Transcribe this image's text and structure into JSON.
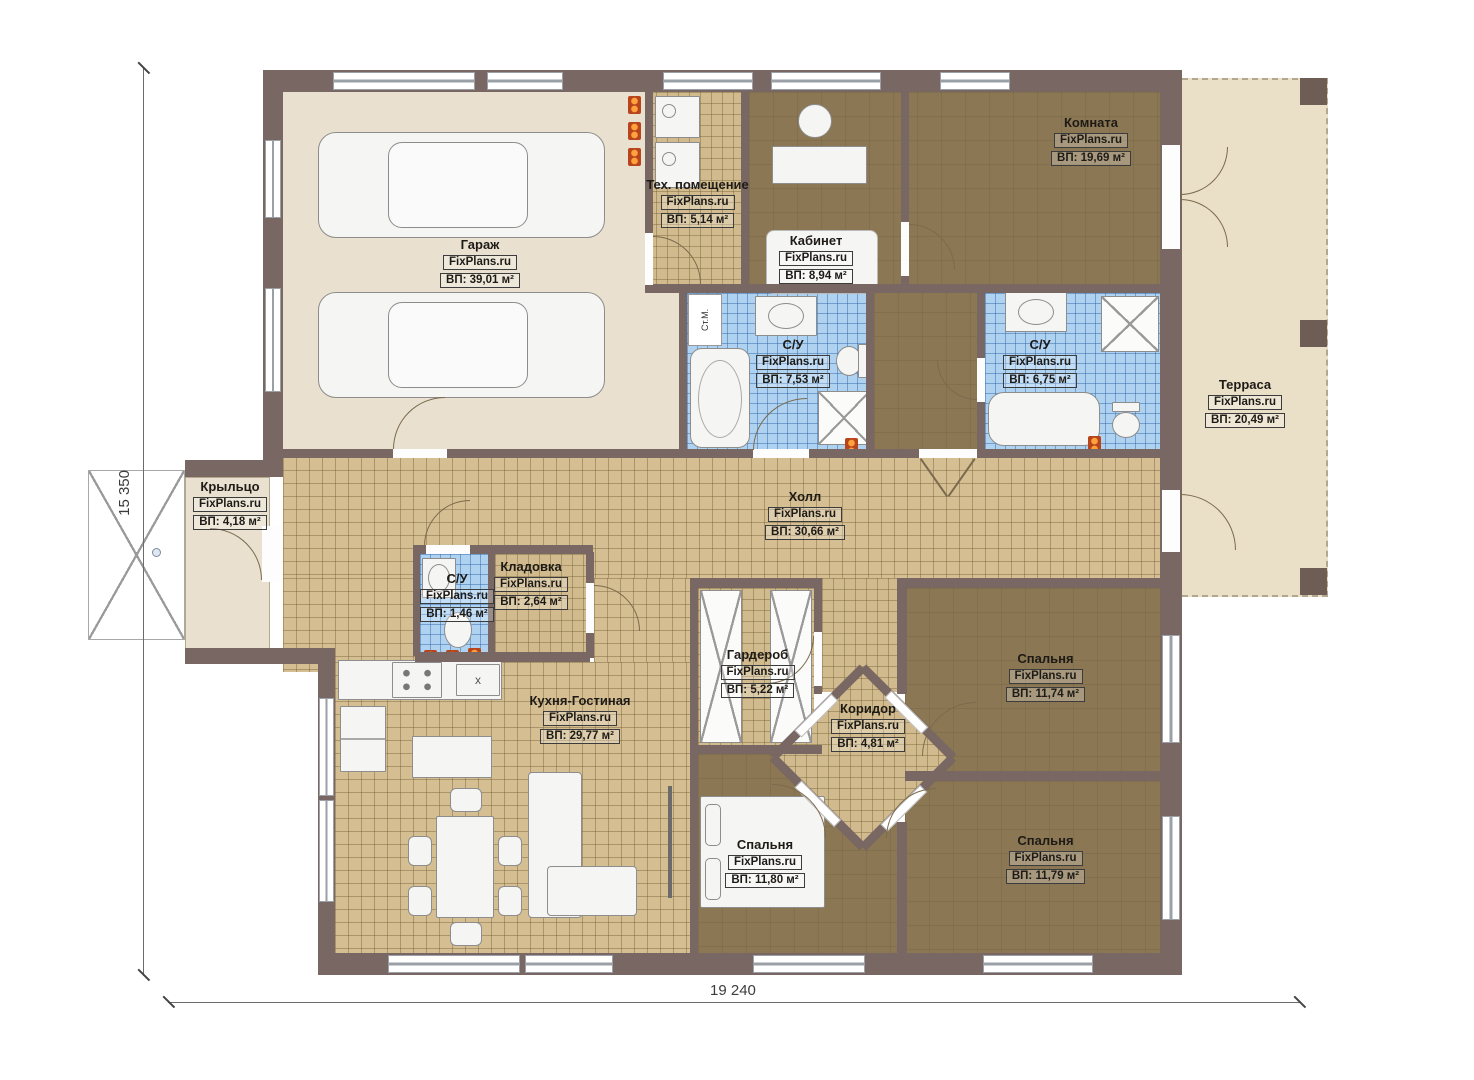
{
  "watermark": "FixPlans.ru",
  "dimensions": {
    "width_label": "19 240",
    "height_label": "15 350"
  },
  "annotations": {
    "washing_machine": "Ст.М.",
    "sink_mark": "x"
  },
  "colors": {
    "wall": "#786762",
    "floor_tile_tan": "#d4be92",
    "floor_tile_blue": "#aed2f0",
    "floor_brown": "#8b7753",
    "floor_beige": "#e9e0cf",
    "terrace": "#eadfc7",
    "heater_orange": "#ff8a2a",
    "door_arc": "#7b6a4d"
  },
  "rooms": [
    {
      "id": "garage",
      "name": "Гараж",
      "area": "ВП: 39,01 м²"
    },
    {
      "id": "tech-room",
      "name": "Тех. помещение",
      "area": "ВП: 5,14 м²"
    },
    {
      "id": "office",
      "name": "Кабинет",
      "area": "ВП: 8,94 м²"
    },
    {
      "id": "room",
      "name": "Комната",
      "area": "ВП: 19,69 м²"
    },
    {
      "id": "bathroom-left",
      "name": "С/У",
      "area": "ВП: 7,53 м²"
    },
    {
      "id": "bathroom-right",
      "name": "С/У",
      "area": "ВП: 6,75 м²"
    },
    {
      "id": "terrace",
      "name": "Терраса",
      "area": "ВП: 20,49 м²"
    },
    {
      "id": "porch",
      "name": "Крыльцо",
      "area": "ВП: 4,18 м²"
    },
    {
      "id": "hall",
      "name": "Холл",
      "area": "ВП: 30,66 м²"
    },
    {
      "id": "bathroom-small",
      "name": "С/У",
      "area": "ВП: 1,46 м²"
    },
    {
      "id": "storage",
      "name": "Кладовка",
      "area": "ВП: 2,64 м²"
    },
    {
      "id": "kitchen-living",
      "name": "Кухня-Гостиная",
      "area": "ВП: 29,77 м²"
    },
    {
      "id": "wardrobe",
      "name": "Гардероб",
      "area": "ВП: 5,22 м²"
    },
    {
      "id": "corridor",
      "name": "Коридор",
      "area": "ВП: 4,81 м²"
    },
    {
      "id": "bedroom-right",
      "name": "Спальня",
      "area": "ВП: 11,74 м²"
    },
    {
      "id": "bedroom-bottom-left",
      "name": "Спальня",
      "area": "ВП: 11,80 м²"
    },
    {
      "id": "bedroom-bottom-right",
      "name": "Спальня",
      "area": "ВП: 11,79 м²"
    }
  ]
}
